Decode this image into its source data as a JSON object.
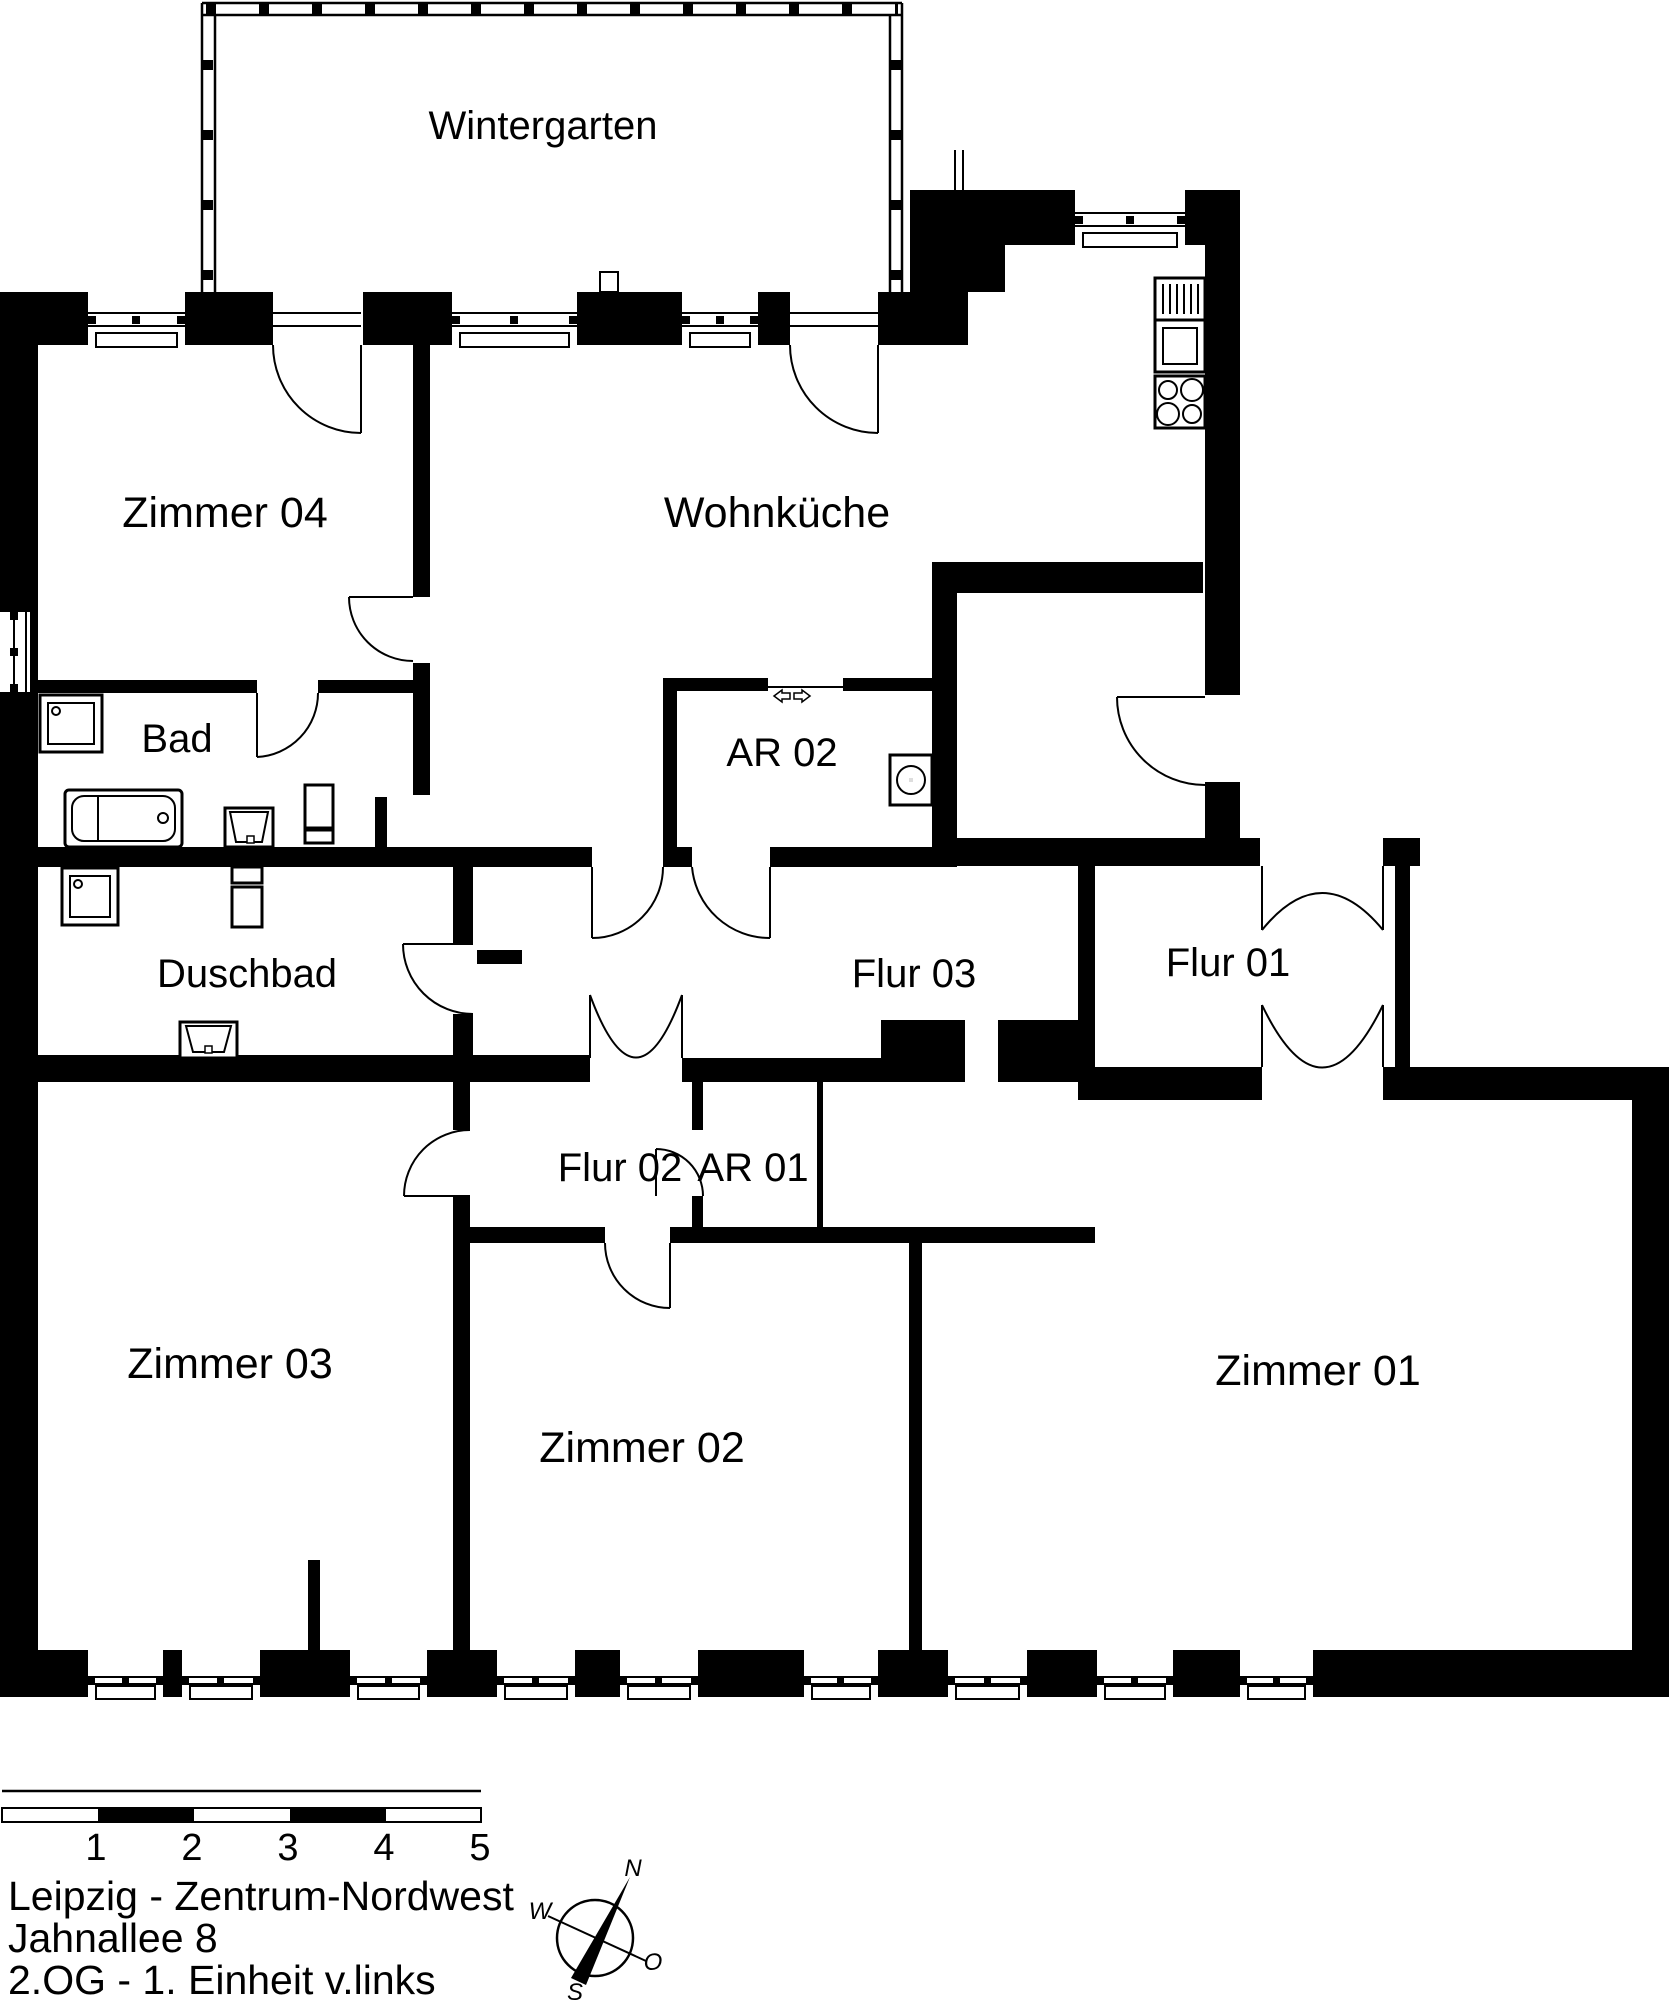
{
  "plan": {
    "rooms": [
      {
        "id": "wintergarten",
        "label": "Wintergarten"
      },
      {
        "id": "zimmer04",
        "label": "Zimmer 04"
      },
      {
        "id": "wohnkueche",
        "label": "Wohnküche"
      },
      {
        "id": "bad",
        "label": "Bad"
      },
      {
        "id": "ar02",
        "label": "AR 02"
      },
      {
        "id": "duschbad",
        "label": "Duschbad"
      },
      {
        "id": "flur03",
        "label": "Flur 03"
      },
      {
        "id": "flur01",
        "label": "Flur 01"
      },
      {
        "id": "flur02",
        "label": "Flur 02"
      },
      {
        "id": "ar01",
        "label": "AR 01"
      },
      {
        "id": "zimmer03",
        "label": "Zimmer 03"
      },
      {
        "id": "zimmer02",
        "label": "Zimmer 02"
      },
      {
        "id": "zimmer01",
        "label": "Zimmer 01"
      }
    ],
    "fixtures": [
      "bathtub",
      "washbasin",
      "washbasin",
      "washbasin",
      "toilet",
      "washing-machine",
      "stove-oven",
      "hob",
      "sliding-door-arrows"
    ]
  },
  "scale_bar": {
    "ticks": [
      "1",
      "2",
      "3",
      "4",
      "5"
    ]
  },
  "address": {
    "line1": "Leipzig - Zentrum-Nordwest",
    "line2": "Jahnallee 8",
    "line3": "2.OG - 1. Einheit v.links"
  },
  "compass": {
    "north": "N",
    "east": "O",
    "south": "S",
    "west": "W"
  },
  "colors": {
    "wall": "#000000",
    "background": "#ffffff",
    "line": "#1a1a1a"
  }
}
